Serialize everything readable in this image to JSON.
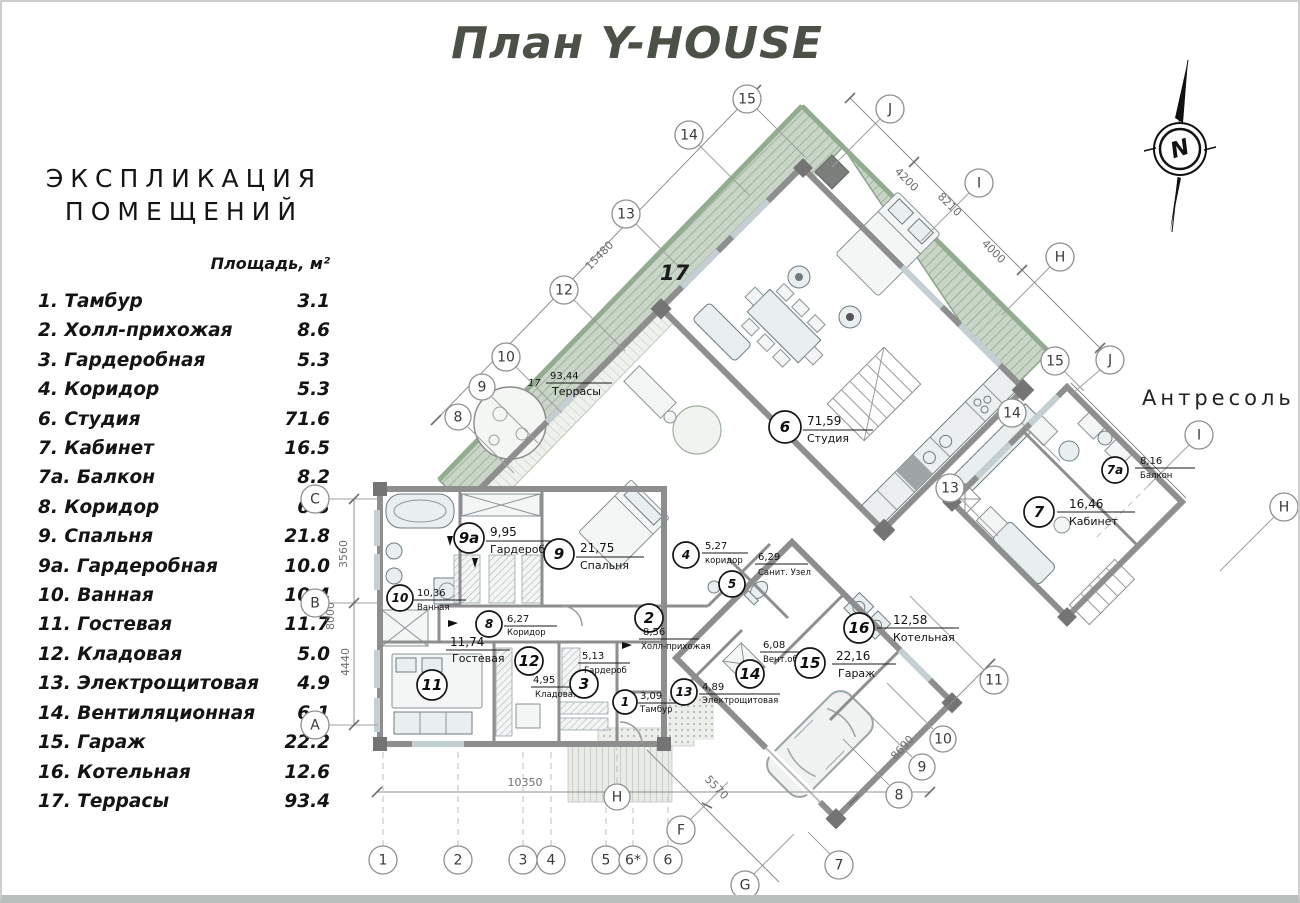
{
  "title": "План Y-HOUSE",
  "legend": {
    "heading_line1": "ЭКСПЛИКАЦИЯ",
    "heading_line2": "ПОМЕЩЕНИЙ",
    "column_header": "Площадь, м²",
    "rows": [
      {
        "name": "1. Тамбур",
        "area": "3.1"
      },
      {
        "name": "2. Холл-прихожая",
        "area": "8.6"
      },
      {
        "name": "3. Гардеробная",
        "area": "5.3"
      },
      {
        "name": "4. Коридор",
        "area": "5.3"
      },
      {
        "name": "6. Студия",
        "area": "71.6"
      },
      {
        "name": "7. Кабинет",
        "area": "16.5"
      },
      {
        "name": "7а. Балкон",
        "area": "8.2"
      },
      {
        "name": "8. Коридор",
        "area": "6.3"
      },
      {
        "name": "9. Спальня",
        "area": "21.8"
      },
      {
        "name": "9а. Гардеробная",
        "area": "10.0"
      },
      {
        "name": "10. Ванная",
        "area": "10.4"
      },
      {
        "name": "11. Гостевая",
        "area": "11.7"
      },
      {
        "name": "12. Кладовая",
        "area": "5.0"
      },
      {
        "name": "13. Электрощитовая",
        "area": "4.9"
      },
      {
        "name": "14. Вентиляционная",
        "area": "6.1"
      },
      {
        "name": "15. Гараж",
        "area": "22.2"
      },
      {
        "name": "16. Котельная",
        "area": "12.6"
      },
      {
        "name": "17. Террасы",
        "area": "93.4"
      }
    ]
  },
  "mezzanine_title": "Антресоль",
  "compass_letter": "N",
  "roof_mark": "17",
  "rooms": {
    "r1": {
      "num": "1",
      "area": "3,09",
      "name": "Тамбур"
    },
    "r2": {
      "num": "2",
      "area": "8,56",
      "name": "Холл-прихожая"
    },
    "r3": {
      "num": "3",
      "area": "5,13",
      "name": "Гардероб"
    },
    "r4": {
      "num": "4",
      "area": "5,27",
      "name": "коридор"
    },
    "r5": {
      "num": "5",
      "area": "6,29",
      "name": "Санит. Узел"
    },
    "r6": {
      "num": "6",
      "area": "71,59",
      "name": "Студия"
    },
    "r7": {
      "num": "7",
      "area": "16,46",
      "name": "Кабинет"
    },
    "r7a": {
      "num": "7а",
      "area": "8,16",
      "name": "Балкон"
    },
    "r8": {
      "num": "8",
      "area": "6,27",
      "name": "Коридор"
    },
    "r9": {
      "num": "9",
      "area": "21,75",
      "name": "Спальня"
    },
    "r9a": {
      "num": "9а",
      "area": "9,95",
      "name": "Гардероб"
    },
    "r10": {
      "num": "10",
      "area": "10,36",
      "name": "Ванная"
    },
    "r11": {
      "num": "11",
      "area": "11,74",
      "name": "Гостевая"
    },
    "r12": {
      "num": "12",
      "area": "4,95",
      "name": "Кладовая"
    },
    "r13": {
      "num": "13",
      "area": "4,89",
      "name": "Электрощитовая"
    },
    "r14": {
      "num": "14",
      "area": "6,08",
      "name": "Вент.оборуд"
    },
    "r15": {
      "num": "15",
      "area": "22,16",
      "name": "Гараж"
    },
    "r16": {
      "num": "16",
      "area": "12,58",
      "name": "Котельная"
    },
    "t17": {
      "num": "17",
      "area": "93,44",
      "name": "Террасы"
    }
  },
  "axes": {
    "upper_left": [
      "15",
      "14",
      "13",
      "12",
      "10",
      "9",
      "8"
    ],
    "upper_right": [
      "J",
      "I",
      "H"
    ],
    "left": [
      "C",
      "B",
      "A"
    ],
    "bottom": [
      "1",
      "2",
      "3",
      "4",
      "5",
      "6*",
      "6"
    ],
    "bottom_mid": [
      "H",
      "F",
      "G",
      "7"
    ],
    "lower_right": [
      "8",
      "9",
      "10",
      "11"
    ],
    "mezz": [
      "13",
      "14",
      "15",
      "J",
      "I",
      "H"
    ]
  },
  "dimensions": {
    "upper_left": "15480",
    "top_right": [
      "4200",
      "8210",
      "4000"
    ],
    "left": [
      "3560",
      "8000",
      "4440"
    ],
    "bottom": "10350",
    "bottom_diag": "5570",
    "right_diag": "8690"
  }
}
